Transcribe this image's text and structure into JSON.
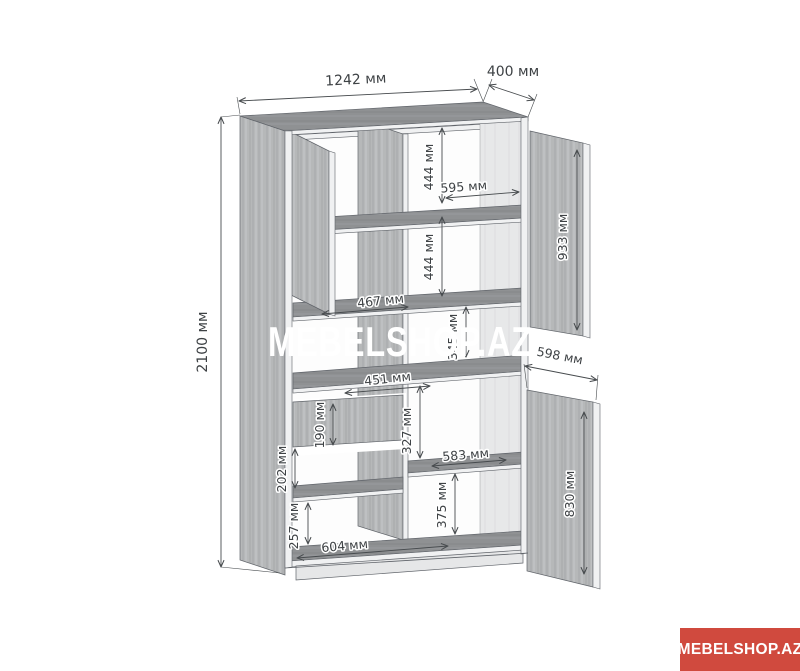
{
  "watermark": {
    "text": "MEBELSHOP.AZ"
  },
  "brand_badge": {
    "text": "MEBELSHOP.AZ",
    "color": "#d04a3e"
  },
  "diagram": {
    "unit": "мм",
    "dimensions": {
      "total_height": "2100 мм",
      "total_width": "1242 мм",
      "total_depth": "400 мм",
      "top_door_height": "933 мм",
      "bottom_door_height": "830 мм",
      "bottom_door_width": "598 мм",
      "upper_right_gap": "444 мм",
      "lower_right_gap": "444 мм",
      "upper_shelf_width": "595 мм",
      "left_shelf_width": "467 мм",
      "middle_right_gap": "345 мм",
      "desk_shelf_width": "451 мм",
      "drawer_front_height": "190 мм",
      "below_desk_gap": "327 мм",
      "lower_shelf_width": "583 мм",
      "below_drawer_gap": "202 мм",
      "bottom_right_gap": "375 мм",
      "bottom_left_gap": "257 мм",
      "base_shelf_width": "604 мм"
    }
  }
}
